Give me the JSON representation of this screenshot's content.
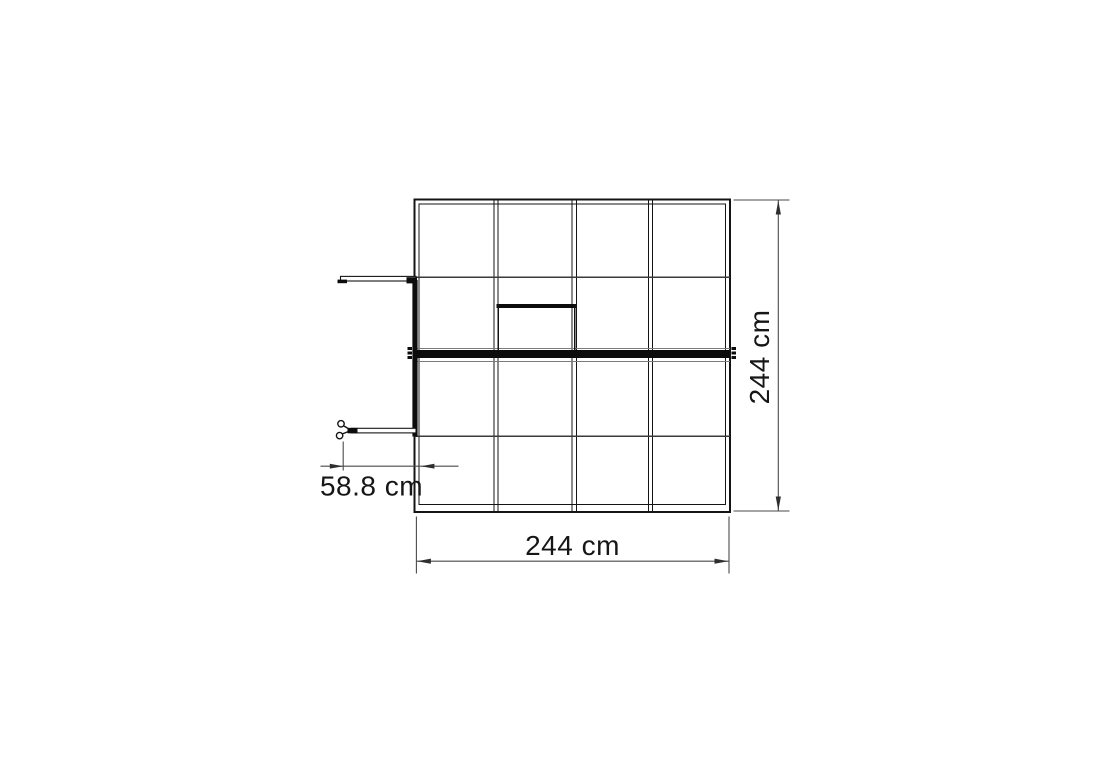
{
  "drawing": {
    "type": "greenhouse-top-view-technical-drawing",
    "colors": {
      "background": "#ffffff",
      "frame_line": "#141414",
      "thin_dimension_line": "#4a4a4a",
      "label_text": "#161616"
    },
    "dimensions": {
      "height": {
        "label": "244 cm",
        "position": "right",
        "orientation": "vertical"
      },
      "width": {
        "label": "244 cm",
        "position": "bottom",
        "orientation": "horizontal"
      },
      "door_offset": {
        "label": "58.8 cm",
        "position": "left",
        "orientation": "horizontal"
      }
    }
  }
}
